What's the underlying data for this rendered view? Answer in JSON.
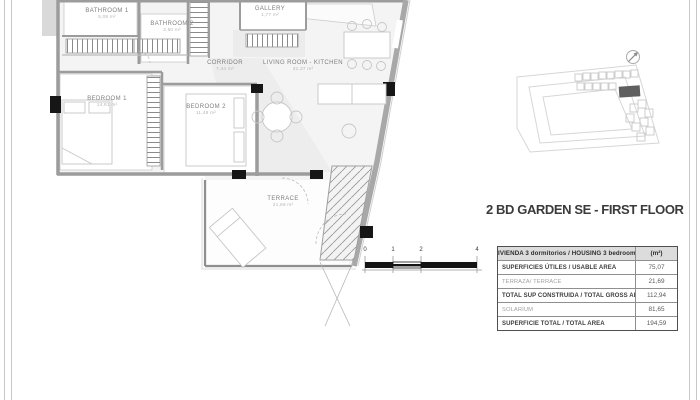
{
  "sheet": {
    "title": "2 BD GARDEN SE - FIRST FLOOR"
  },
  "plan": {
    "rooms": [
      {
        "name": "BATHROOM 1",
        "area": "5,09 m²"
      },
      {
        "name": "BATHROOM 2",
        "area": "3,60 m²"
      },
      {
        "name": "GALLERY",
        "area": "1,77 m²"
      },
      {
        "name": "CORRIDOR",
        "area": "7,44 m²"
      },
      {
        "name": "LIVING ROOM - KITCHEN",
        "area": "31,37 m²"
      },
      {
        "name": "BEDROOM 1",
        "area": "14,81 m²"
      },
      {
        "name": "BEDROOM 2",
        "area": "11,48 m²"
      },
      {
        "name": "TERRACE",
        "area": "21,69 m²"
      }
    ]
  },
  "scale_bar": {
    "labels": [
      "0",
      "1",
      "2",
      "4"
    ]
  },
  "area_table": {
    "header": {
      "label": "VIVIENDA 3 dormitorios / HOUSING 3 bedrooms",
      "unit": "(m²)"
    },
    "rows": [
      {
        "label": "SUPERFICIES ÚTILES / USABLE AREA",
        "value": "75,07"
      },
      {
        "label": "TERRAZA/ TERRACE",
        "value": "21,69"
      },
      {
        "label": "TOTAL SUP CONSTRUIDA / TOTAL GROSS AREA",
        "value": "112,94"
      },
      {
        "label": "SOLARIUM",
        "value": "81,65"
      },
      {
        "label": "SUPERFICIE TOTAL / TOTAL  AREA",
        "value": "194,59"
      }
    ]
  },
  "colors": {
    "wall_gray": "#9c9c9c",
    "marker_black": "#161616",
    "site_key_outline": "#d6d6d6",
    "site_key_highlight": "#5f5f5f",
    "table_header_bg": "#dcdcdc"
  }
}
